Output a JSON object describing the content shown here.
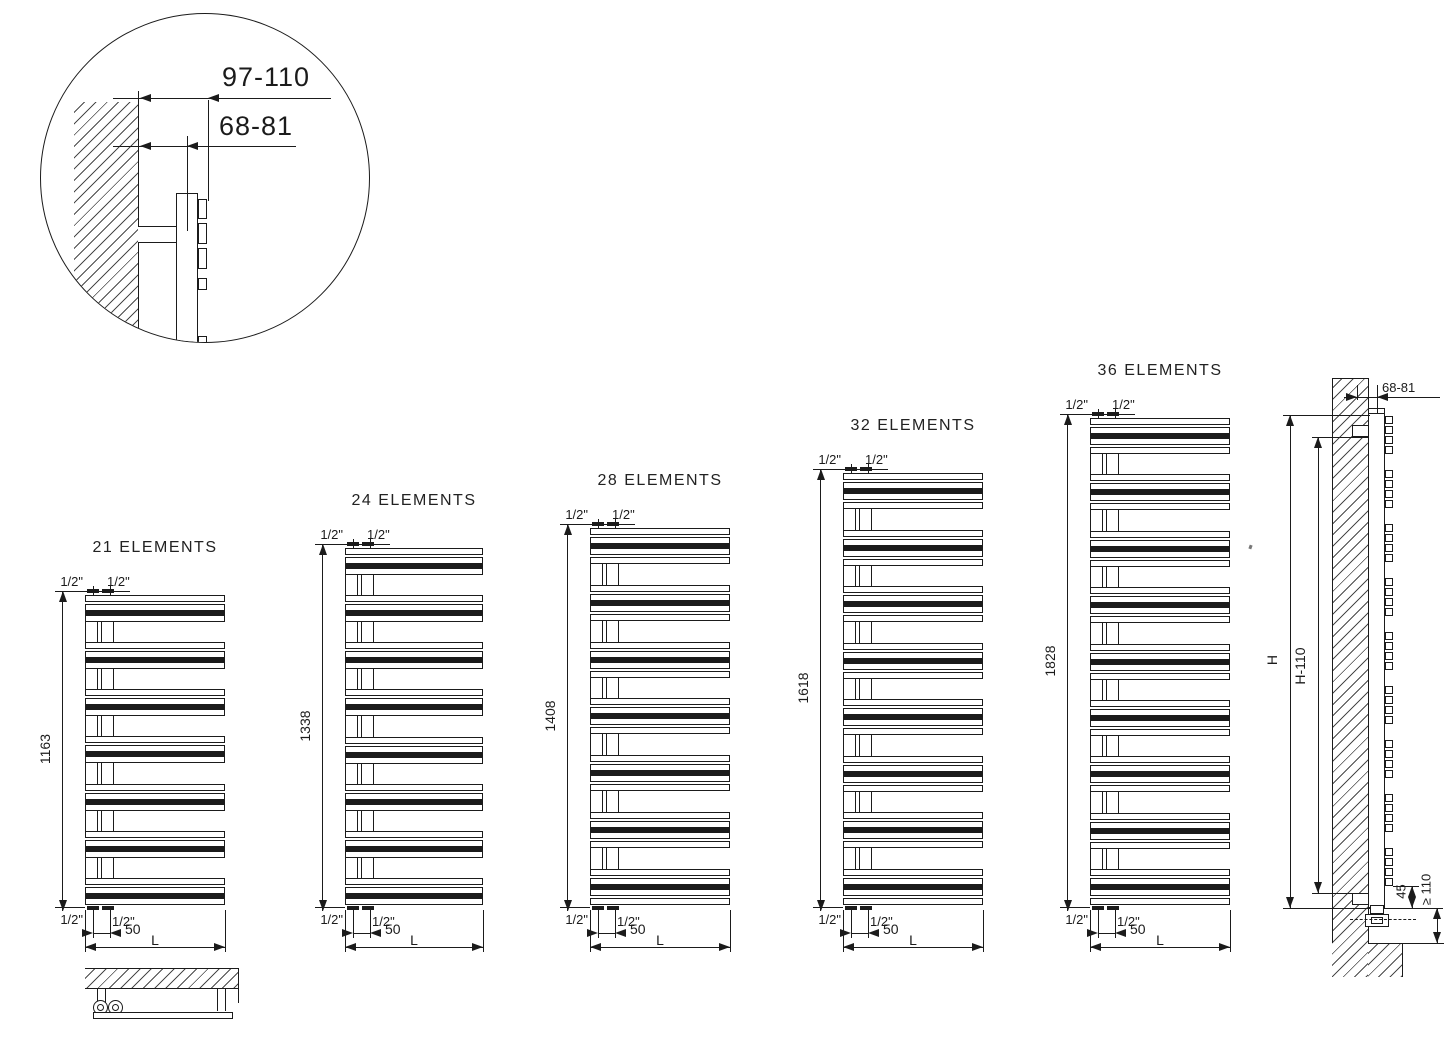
{
  "detail_circle": {
    "dim_outer": "97-110",
    "dim_inner": "68-81"
  },
  "radiators": [
    {
      "title": "21 ELEMENTS",
      "groups": 7,
      "per_group": 3,
      "height_label": "1163",
      "conn_top_left": "1/2\"",
      "conn_top_right": "1/2\"",
      "conn_bottom_left": "1/2\"",
      "conn_bottom_right": "1/2\"",
      "pitch_label": "50",
      "width_label": "L"
    },
    {
      "title": "24 ELEMENTS",
      "groups": 8,
      "per_group": 3,
      "height_label": "1338",
      "conn_top_left": "1/2\"",
      "conn_top_right": "1/2\"",
      "conn_bottom_left": "1/2\"",
      "conn_bottom_right": "1/2\"",
      "pitch_label": "50",
      "width_label": "L"
    },
    {
      "title": "28 ELEMENTS",
      "groups": 7,
      "per_group": 4,
      "height_label": "1408",
      "conn_top_left": "1/2\"",
      "conn_top_right": "1/2\"",
      "conn_bottom_left": "1/2\"",
      "conn_bottom_right": "1/2\"",
      "pitch_label": "50",
      "width_label": "L"
    },
    {
      "title": "32 ELEMENTS",
      "groups": 8,
      "per_group": 4,
      "height_label": "1618",
      "conn_top_left": "1/2\"",
      "conn_top_right": "1/2\"",
      "conn_bottom_left": "1/2\"",
      "conn_bottom_right": "1/2\"",
      "pitch_label": "50",
      "width_label": "L"
    },
    {
      "title": "36 ELEMENTS",
      "groups": 9,
      "per_group": 4,
      "height_label": "1828",
      "conn_top_left": "1/2\"",
      "conn_top_right": "1/2\"",
      "conn_bottom_left": "1/2\"",
      "conn_bottom_right": "1/2\"",
      "pitch_label": "50",
      "width_label": "L"
    }
  ],
  "side_view": {
    "groups": 9,
    "per_group": 4,
    "wall_offset_label": "68-81",
    "height_label": "H",
    "height_minus_label": "H-110",
    "bottom_offset_label": "45",
    "floor_clearance_label": "≥ 110"
  }
}
